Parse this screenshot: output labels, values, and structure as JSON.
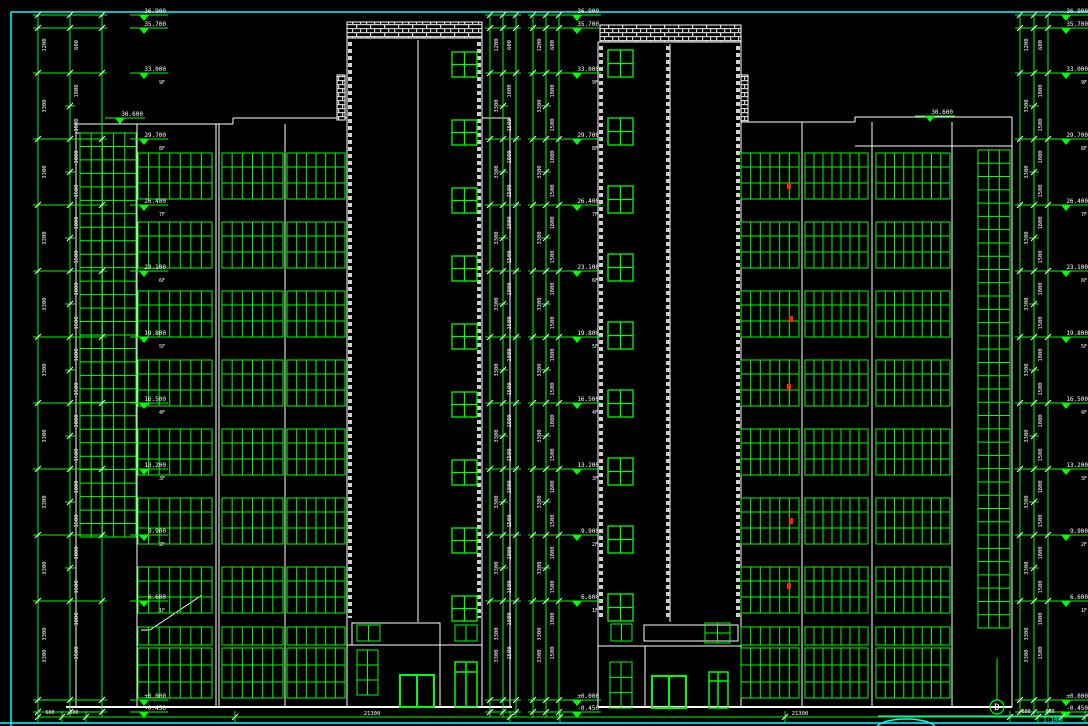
{
  "drawing": {
    "type": "architectural-elevation-cad",
    "labels": {
      "grid_bubble": "D",
      "scale_note": "1:100",
      "roof_level": "30.600"
    },
    "elevation_markers": {
      "levels": [
        "36.900",
        "35.700",
        "33.000",
        "29.700",
        "26.400",
        "23.100",
        "19.800",
        "16.500",
        "13.200",
        "9.900",
        "6.600",
        "±0.000",
        "-0.450"
      ],
      "storeys": [
        "",
        "",
        "9F",
        "8F",
        "7F",
        "6F",
        "5F",
        "4F",
        "3F",
        "2F",
        "1F",
        "",
        ""
      ]
    },
    "dimension_numbers": {
      "storey_height": "3300",
      "window_height": "1800",
      "sill_height": "1500",
      "parapet": "1200",
      "end_segment": "600"
    },
    "total_dimensions": {
      "left_building": "21300",
      "right_building": "21300"
    },
    "colors": {
      "line_green": "#00ff00",
      "line_white": "#ffffff",
      "frame_cyan": "#00ffff",
      "hatch_gray": "#cfcfcf",
      "mark_red": "#ff2600",
      "background": "#000000"
    }
  }
}
